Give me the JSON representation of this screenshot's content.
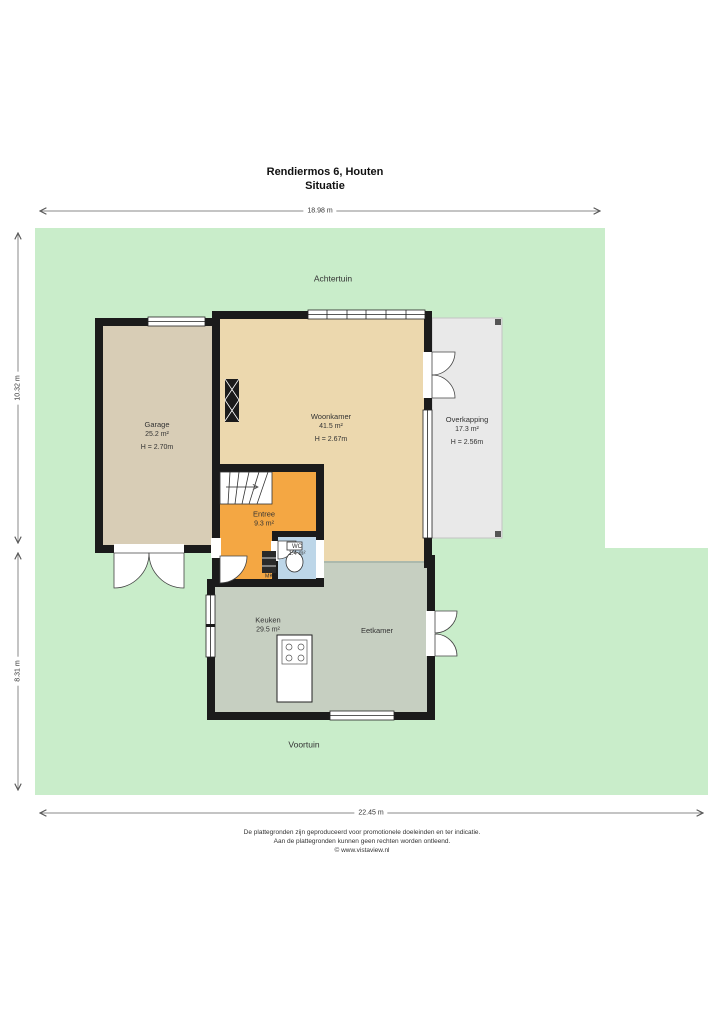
{
  "title": {
    "address": "Rendiermos 6, Houten",
    "subtitle": "Situatie"
  },
  "dimensions": {
    "top": "18.98 m",
    "left_upper": "10.32 m",
    "left_lower": "8.31 m",
    "bottom": "22.45 m"
  },
  "garden": {
    "back": "Achtertuin",
    "front": "Voortuin"
  },
  "rooms": {
    "garage": {
      "name": "Garage",
      "area": "25.2 m²",
      "height": "H = 2.70m"
    },
    "woonkamer": {
      "name": "Woonkamer",
      "area": "41.5 m²",
      "height": "H = 2.67m"
    },
    "overkapping": {
      "name": "Overkapping",
      "area": "17.3 m²",
      "height": "H = 2.56m"
    },
    "entree": {
      "name": "Entree",
      "area": "9.3 m²"
    },
    "wc": {
      "name": "WC",
      "area": "1.4 m²"
    },
    "keuken": {
      "name": "Keuken",
      "area": "29.5 m²"
    },
    "eetkamer": {
      "name": "Eetkamer"
    },
    "meterkast": {
      "abbr": "MK"
    }
  },
  "footer": {
    "line1": "De plattegronden zijn geproduceerd voor promotionele doeleinden en ter indicatie.",
    "line2": "Aan de plattegronden kunnen geen rechten worden ontleend.",
    "line3": "© www.vistaview.nl"
  },
  "colors": {
    "lawn": "#c9edca",
    "wall": "#1b1b1b",
    "garage": "#d8cdb6",
    "woonkamer": "#ecd8ae",
    "entree": "#f4a743",
    "wc": "#bdd6e8",
    "keuken": "#c6cfc1",
    "overkapping": "#e9e9e9"
  }
}
